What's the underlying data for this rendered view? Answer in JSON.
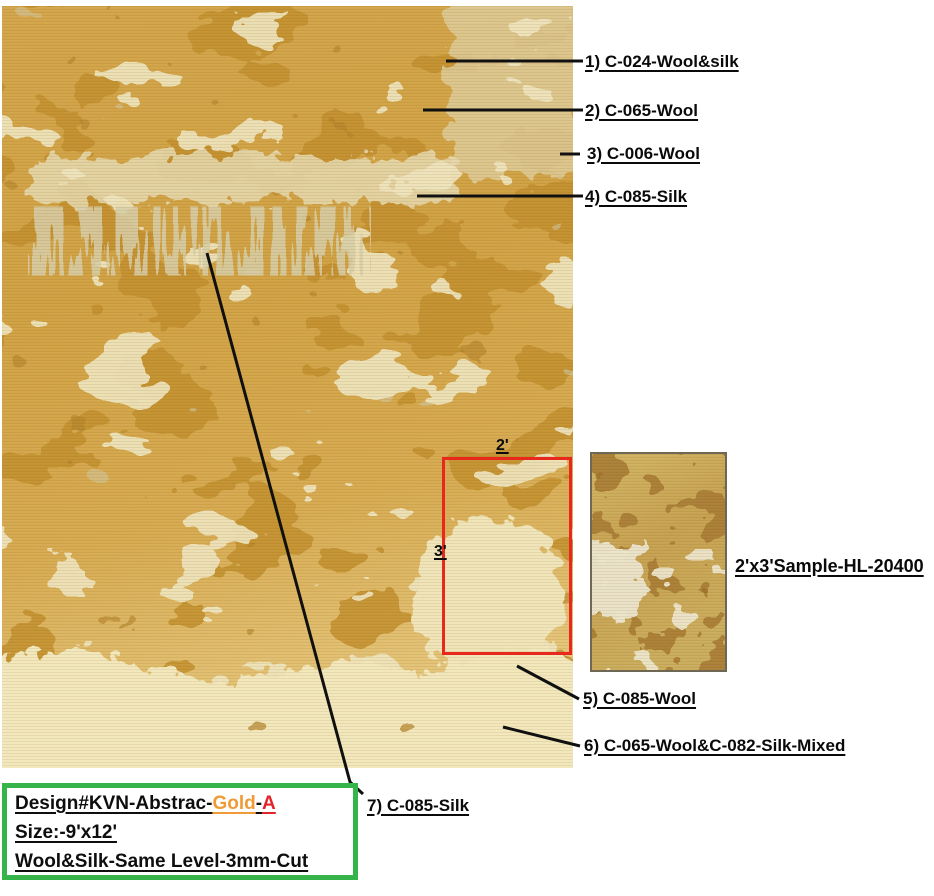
{
  "figure": {
    "description": "Rug color specification sheet with annotated callouts",
    "main_rug_alt": "abstract gold rug 9x12 photo",
    "sample_rug_alt": "2x3 sample rug photo"
  },
  "callouts": [
    {
      "label": "1) C-024-Wool&silk"
    },
    {
      "label": "2) C-065-Wool"
    },
    {
      "label": "3) C-006-Wool"
    },
    {
      "label": "4) C-085-Silk"
    },
    {
      "label": "5) C-085-Wool"
    },
    {
      "label": "6) C-065-Wool&C-082-Silk-Mixed"
    },
    {
      "label": "7) C-085-Silk"
    }
  ],
  "crop_box": {
    "width_label": "2'",
    "height_label": "3'"
  },
  "sample": {
    "label": "2'x3'Sample-HL-20400"
  },
  "info_box": {
    "design_prefix": "Design#KVN-Abstrac-",
    "design_gold": "Gold",
    "design_sep": "-",
    "design_variant": "A",
    "size_line": "Size:-9'x12'",
    "material_line": "Wool&Silk-Same Level-3mm-Cut"
  },
  "colors": {
    "crop_box_red": "#E9281D",
    "info_border_green": "#35B44A",
    "gold_word": "#F09B37",
    "red_letter": "#E2242A",
    "leader_line": "#101010",
    "rug_base_gold": "#D2A445",
    "rug_dark_gold": "#C2902F",
    "rug_cream": "#F2E8BC",
    "rug_sage": "#D2C9A3"
  }
}
